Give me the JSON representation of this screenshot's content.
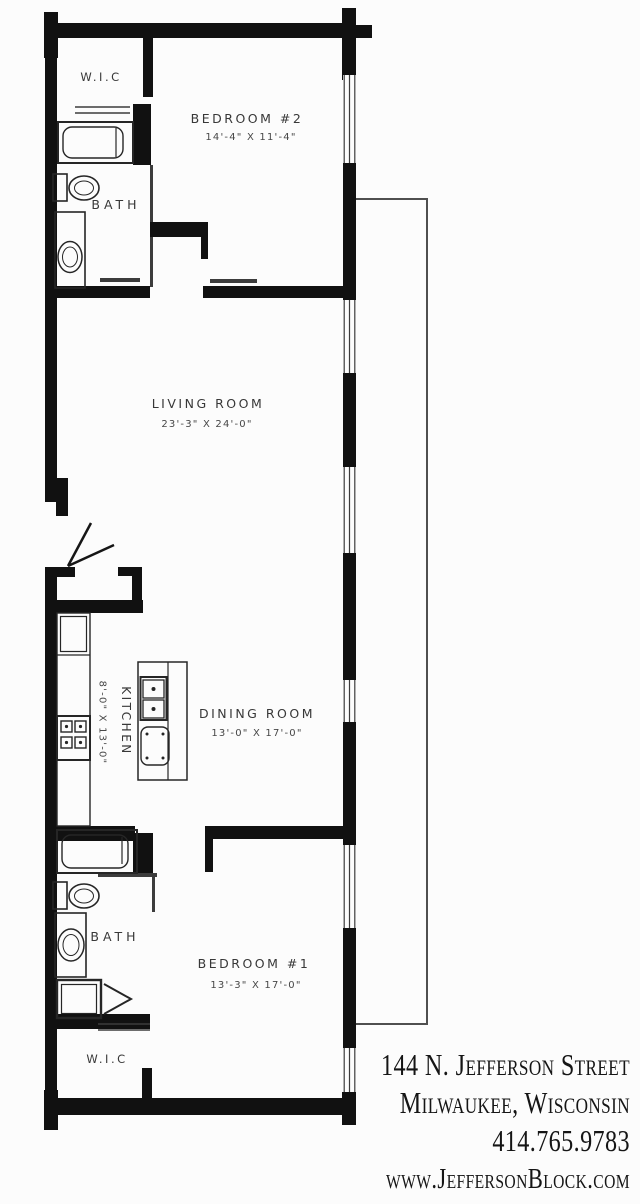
{
  "rooms": {
    "wic_top": {
      "label": "W.I.C"
    },
    "bedroom2": {
      "label": "BEDROOM #2",
      "dims": "14'-4\" X 11'-4\""
    },
    "bath_top": {
      "label": "BATH"
    },
    "living_room": {
      "label": "LIVING ROOM",
      "dims": "23'-3\" X 24'-0\""
    },
    "kitchen": {
      "label": "KITCHEN",
      "dims": "8'-0\" X 13'-0\""
    },
    "dining_room": {
      "label": "DINING ROOM",
      "dims": "13'-0\" X 17'-0\""
    },
    "bath_bottom": {
      "label": "BATH"
    },
    "bedroom1": {
      "label": "BEDROOM #1",
      "dims": "13'-3\" X 17'-0\""
    },
    "wic_bottom": {
      "label": "W.I.C"
    }
  },
  "footer": {
    "address_line1": "144 N. Jefferson Street",
    "address_line2": "Milwaukee, Wisconsin",
    "phone": "414.765.9783",
    "website": "www.JeffersonBlock.com"
  },
  "colors": {
    "wall": "#111111",
    "label_text": "#383838",
    "footer_text": "#151515",
    "background": "#fcfcfc"
  }
}
